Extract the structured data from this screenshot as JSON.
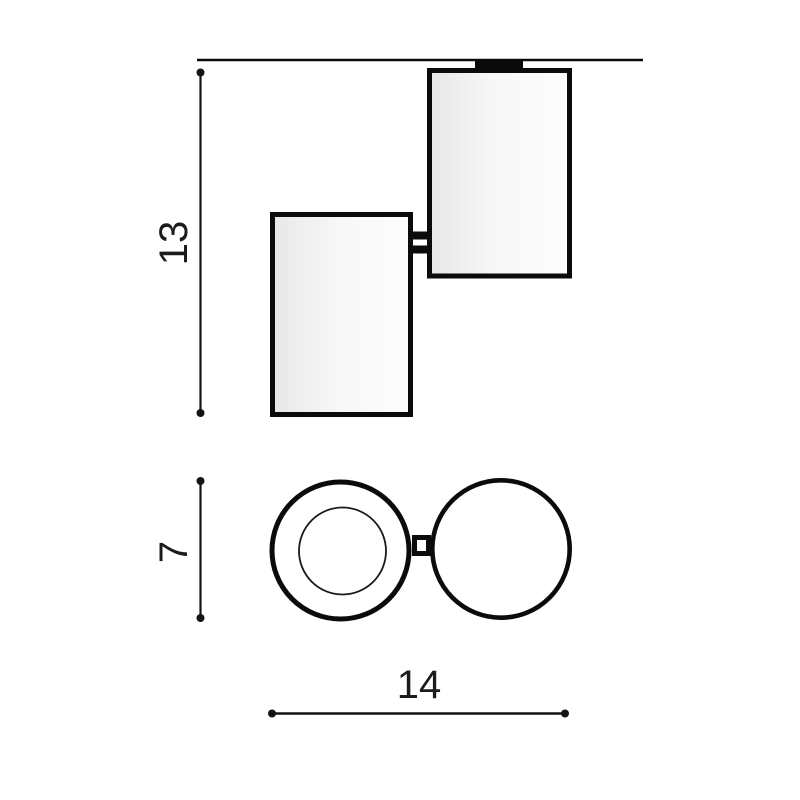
{
  "drawing": {
    "type": "product-dimension-diagram",
    "views": {
      "side_view": "two offset cylinders mounted to ceiling line with hinge bracket",
      "top_view": "two circles joined by hinge, left circle shows inner lens ring"
    },
    "dimensions": {
      "height": {
        "label": "13",
        "orientation": "vertical"
      },
      "diameter": {
        "label": "7",
        "orientation": "vertical"
      },
      "width": {
        "label": "14",
        "orientation": "horizontal"
      }
    },
    "colors": {
      "background": "#ffffff",
      "line": "#0b0b0b",
      "dimension_line": "#141414",
      "text": "#1c1c1c",
      "mount_fill": "#0a0a0a",
      "cylinder_fill_start": "#e7e7e7",
      "cylinder_fill_end": "#fdfdfd"
    }
  }
}
